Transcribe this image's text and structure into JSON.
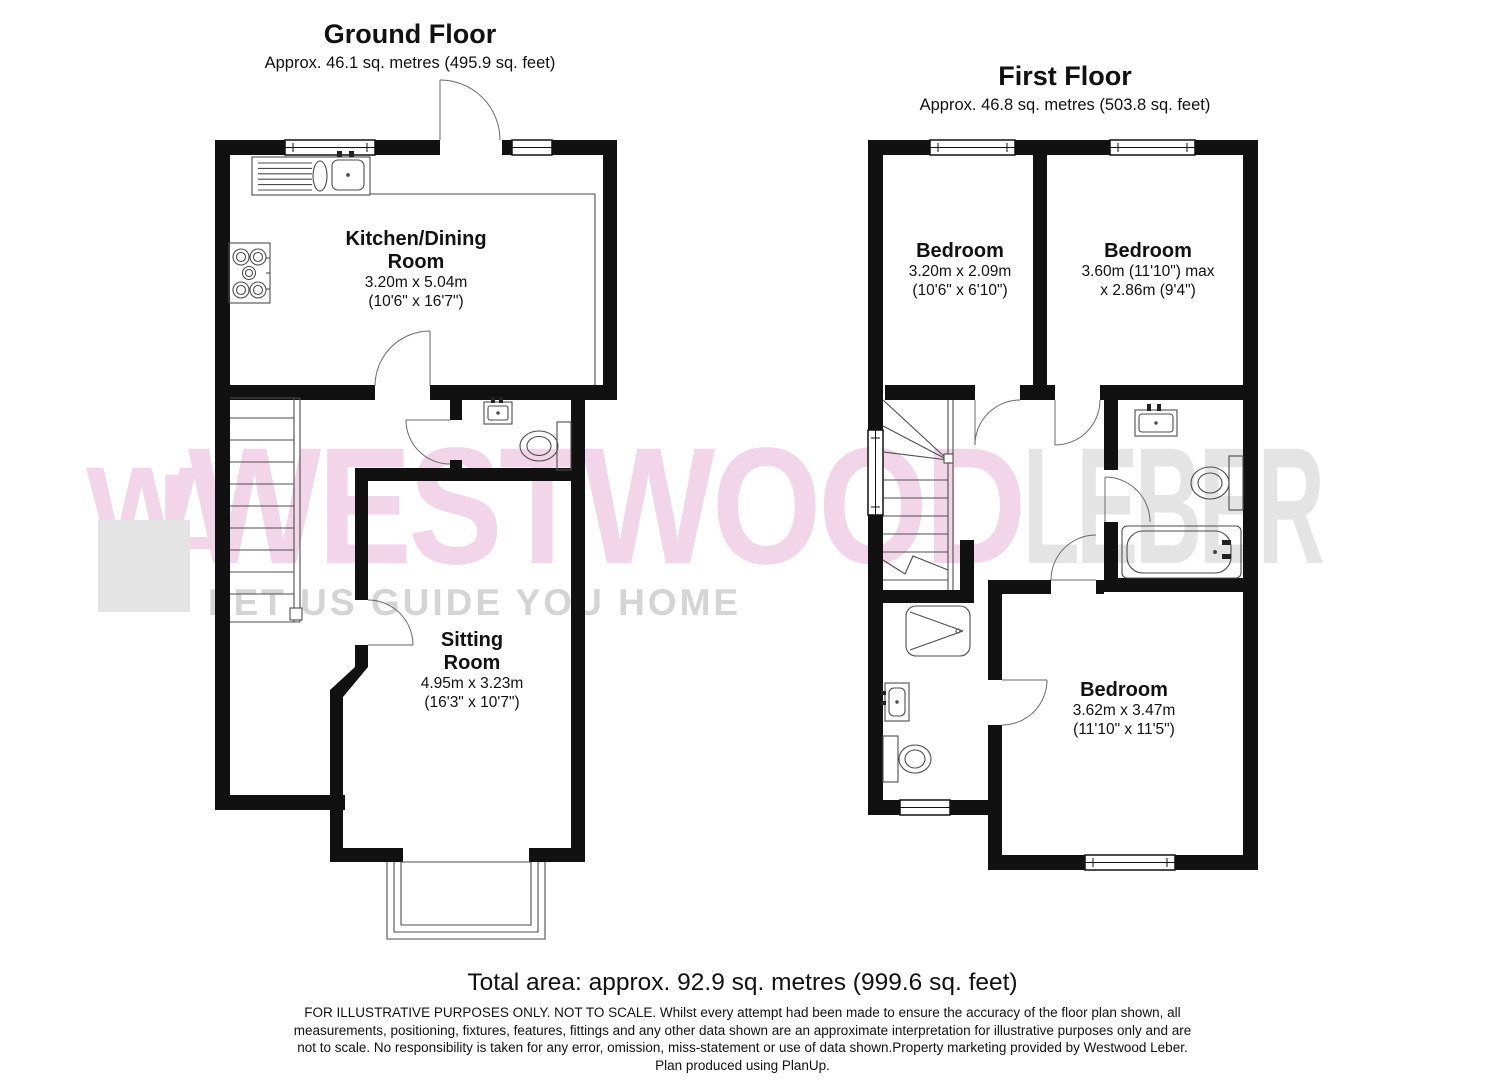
{
  "ground_floor": {
    "title": "Ground Floor",
    "subtitle": "Approx. 46.1 sq. metres (495.9 sq. feet)",
    "rooms": {
      "kitchen": {
        "name_line1": "Kitchen/Dining",
        "name_line2": "Room",
        "dims_metric": "3.20m x 5.04m",
        "dims_imperial": "(10'6\" x 16'7\")"
      },
      "sitting": {
        "name_line1": "Sitting",
        "name_line2": "Room",
        "dims_metric": "4.95m x 3.23m",
        "dims_imperial": "(16'3\" x 10'7\")"
      }
    }
  },
  "first_floor": {
    "title": "First Floor",
    "subtitle": "Approx. 46.8 sq. metres (503.8 sq. feet)",
    "rooms": {
      "bedroom_left": {
        "name": "Bedroom",
        "dims_metric": "3.20m x 2.09m",
        "dims_imperial": "(10'6\" x 6'10\")"
      },
      "bedroom_right": {
        "name": "Bedroom",
        "dims_line1": "3.60m (11'10\") max",
        "dims_line2": "x 2.86m (9'4\")"
      },
      "bedroom_bottom": {
        "name": "Bedroom",
        "dims_metric": "3.62m x 3.47m",
        "dims_imperial": "(11'10\" x 11'5\")"
      }
    }
  },
  "watermark": {
    "logo_w": "W",
    "logo_l": "L",
    "brand_first": "WESTWOOD",
    "brand_second": "LEBER",
    "tagline": "LET US GUIDE YOU HOME",
    "colors": {
      "pink": "#f2d5e8",
      "gray": "#e4e4e4",
      "tagline_gray": "#d4d4d4"
    }
  },
  "footer": {
    "total_area": "Total area: approx. 92.9 sq. metres (999.6 sq. feet)",
    "disclaimer_lines": [
      "FOR ILLUSTRATIVE PURPOSES ONLY. NOT TO SCALE. Whilst every attempt had been made to ensure the accuracy of the floor plan shown, all",
      "measurements, positioning, fixtures, features, fittings and any other data shown are an approximate interpretation for illustrative purposes only and are",
      "not to scale. No responsibility is taken for any error, omission, miss-statement or use of data shown.Property marketing provided by Westwood Leber.",
      "Plan produced using PlanUp."
    ]
  }
}
